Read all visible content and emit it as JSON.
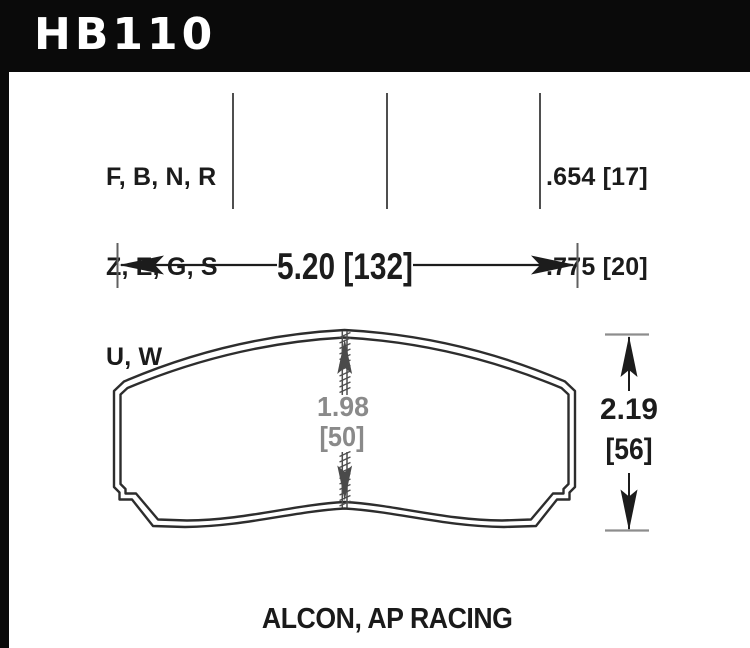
{
  "header": {
    "part_number": "HB110"
  },
  "compound_codes": {
    "line1": "F, B, N, R",
    "line2": "Z, E, G, S",
    "line3": "U, W"
  },
  "pad_thickness": {
    "line1": ".654 [17]",
    "line2": ".775 [20]"
  },
  "dimensions": {
    "width_label": "5.20 [132]",
    "friction_height_value": "1.98",
    "friction_height_bracket": "[50]",
    "overall_height_value": "2.19",
    "overall_height_bracket": "[56]"
  },
  "applications": {
    "label": "ALCON, AP RACING"
  },
  "colors": {
    "frame_black": "#0a0a0a",
    "ink_black": "#1c1c1c",
    "pad_outline": "#2d2d2d",
    "divider_gray": "#4f4f4f",
    "dim_text_gray": "#8a8a8a",
    "tick_gray": "#8d8d8d"
  }
}
